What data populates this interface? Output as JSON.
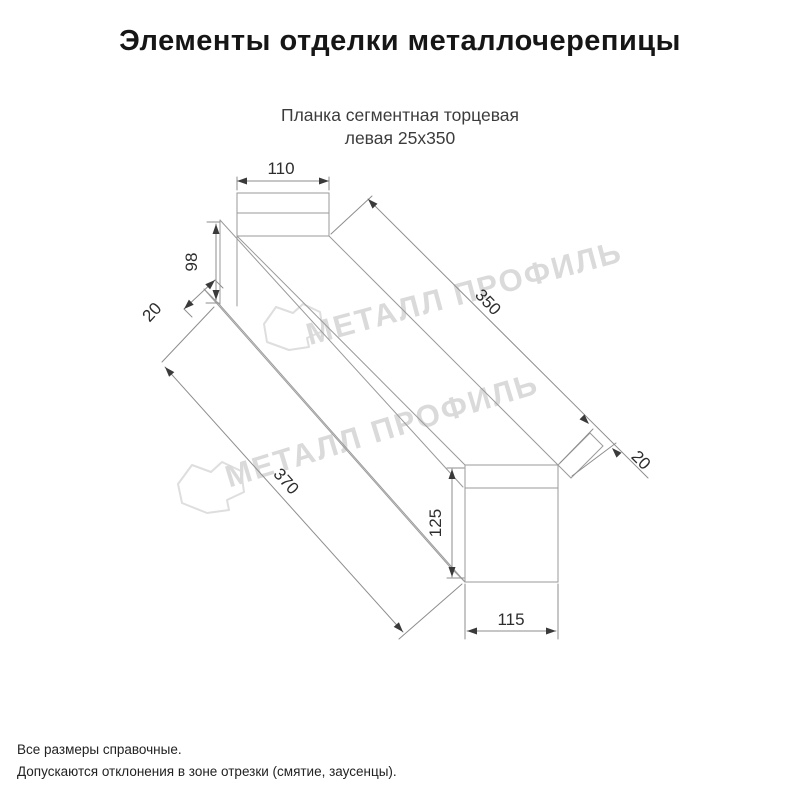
{
  "header": {
    "title": "Элементы отделки металлочерепицы"
  },
  "product": {
    "name_line1": "Планка сегментная торцевая",
    "name_line2": "левая 25x350"
  },
  "drawing": {
    "type": "isometric technical drawing of metal end-trim plank",
    "dimensions": {
      "top_flange_width": "110",
      "web_height": "98",
      "near_hem_width": "20",
      "top_length": "350",
      "far_hem_width": "20",
      "end_face_height": "125",
      "end_face_width": "115",
      "bottom_length": "370"
    },
    "watermark": {
      "text": "МЕТАЛЛ ПРОФИЛЬ",
      "logo": "cloud-logo"
    }
  },
  "footer": {
    "note_line1": "Все размеры справочные.",
    "note_line2": "Допускаются отклонения в зоне отрезки (смятие, заусенцы)."
  },
  "colors": {
    "background": "#ffffff",
    "drawing_line": "#9a9a9a",
    "dimension_text": "#2d2d2d",
    "title_text": "#161616",
    "watermark": "#dadada"
  }
}
